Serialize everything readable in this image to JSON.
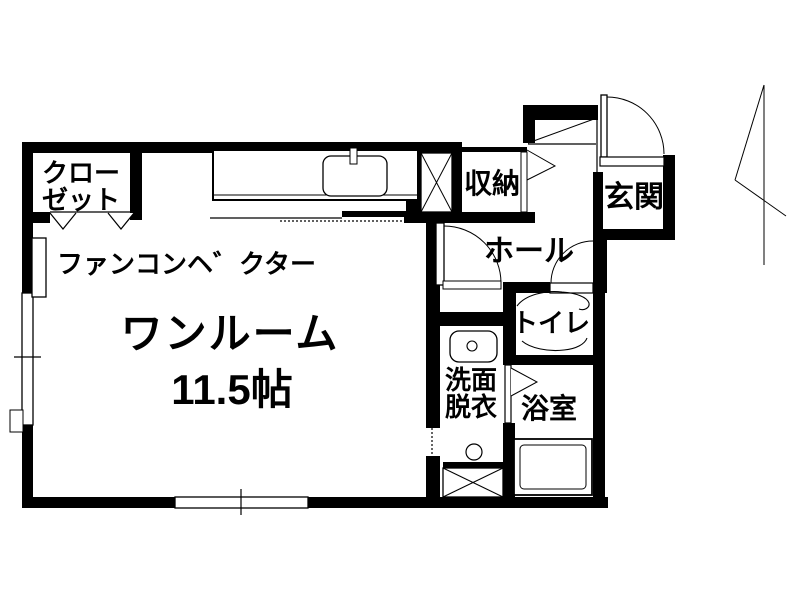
{
  "plan": {
    "type": "apartment-floor-plan",
    "labels": {
      "main_room_name": "ワンルーム",
      "main_room_size": "11.5帖",
      "fan_convector": "ファンコンヘ゛クター",
      "closet_l1": "クロー",
      "closet_l2": "ゼット",
      "storage": "収納",
      "entrance": "玄関",
      "hall": "ホール",
      "toilet": "トイレ",
      "bathroom": "浴室",
      "washroom_l1": "洗面",
      "washroom_l2": "脱衣"
    },
    "colors": {
      "wall": "#000000",
      "background": "#ffffff",
      "line": "#000000"
    }
  }
}
